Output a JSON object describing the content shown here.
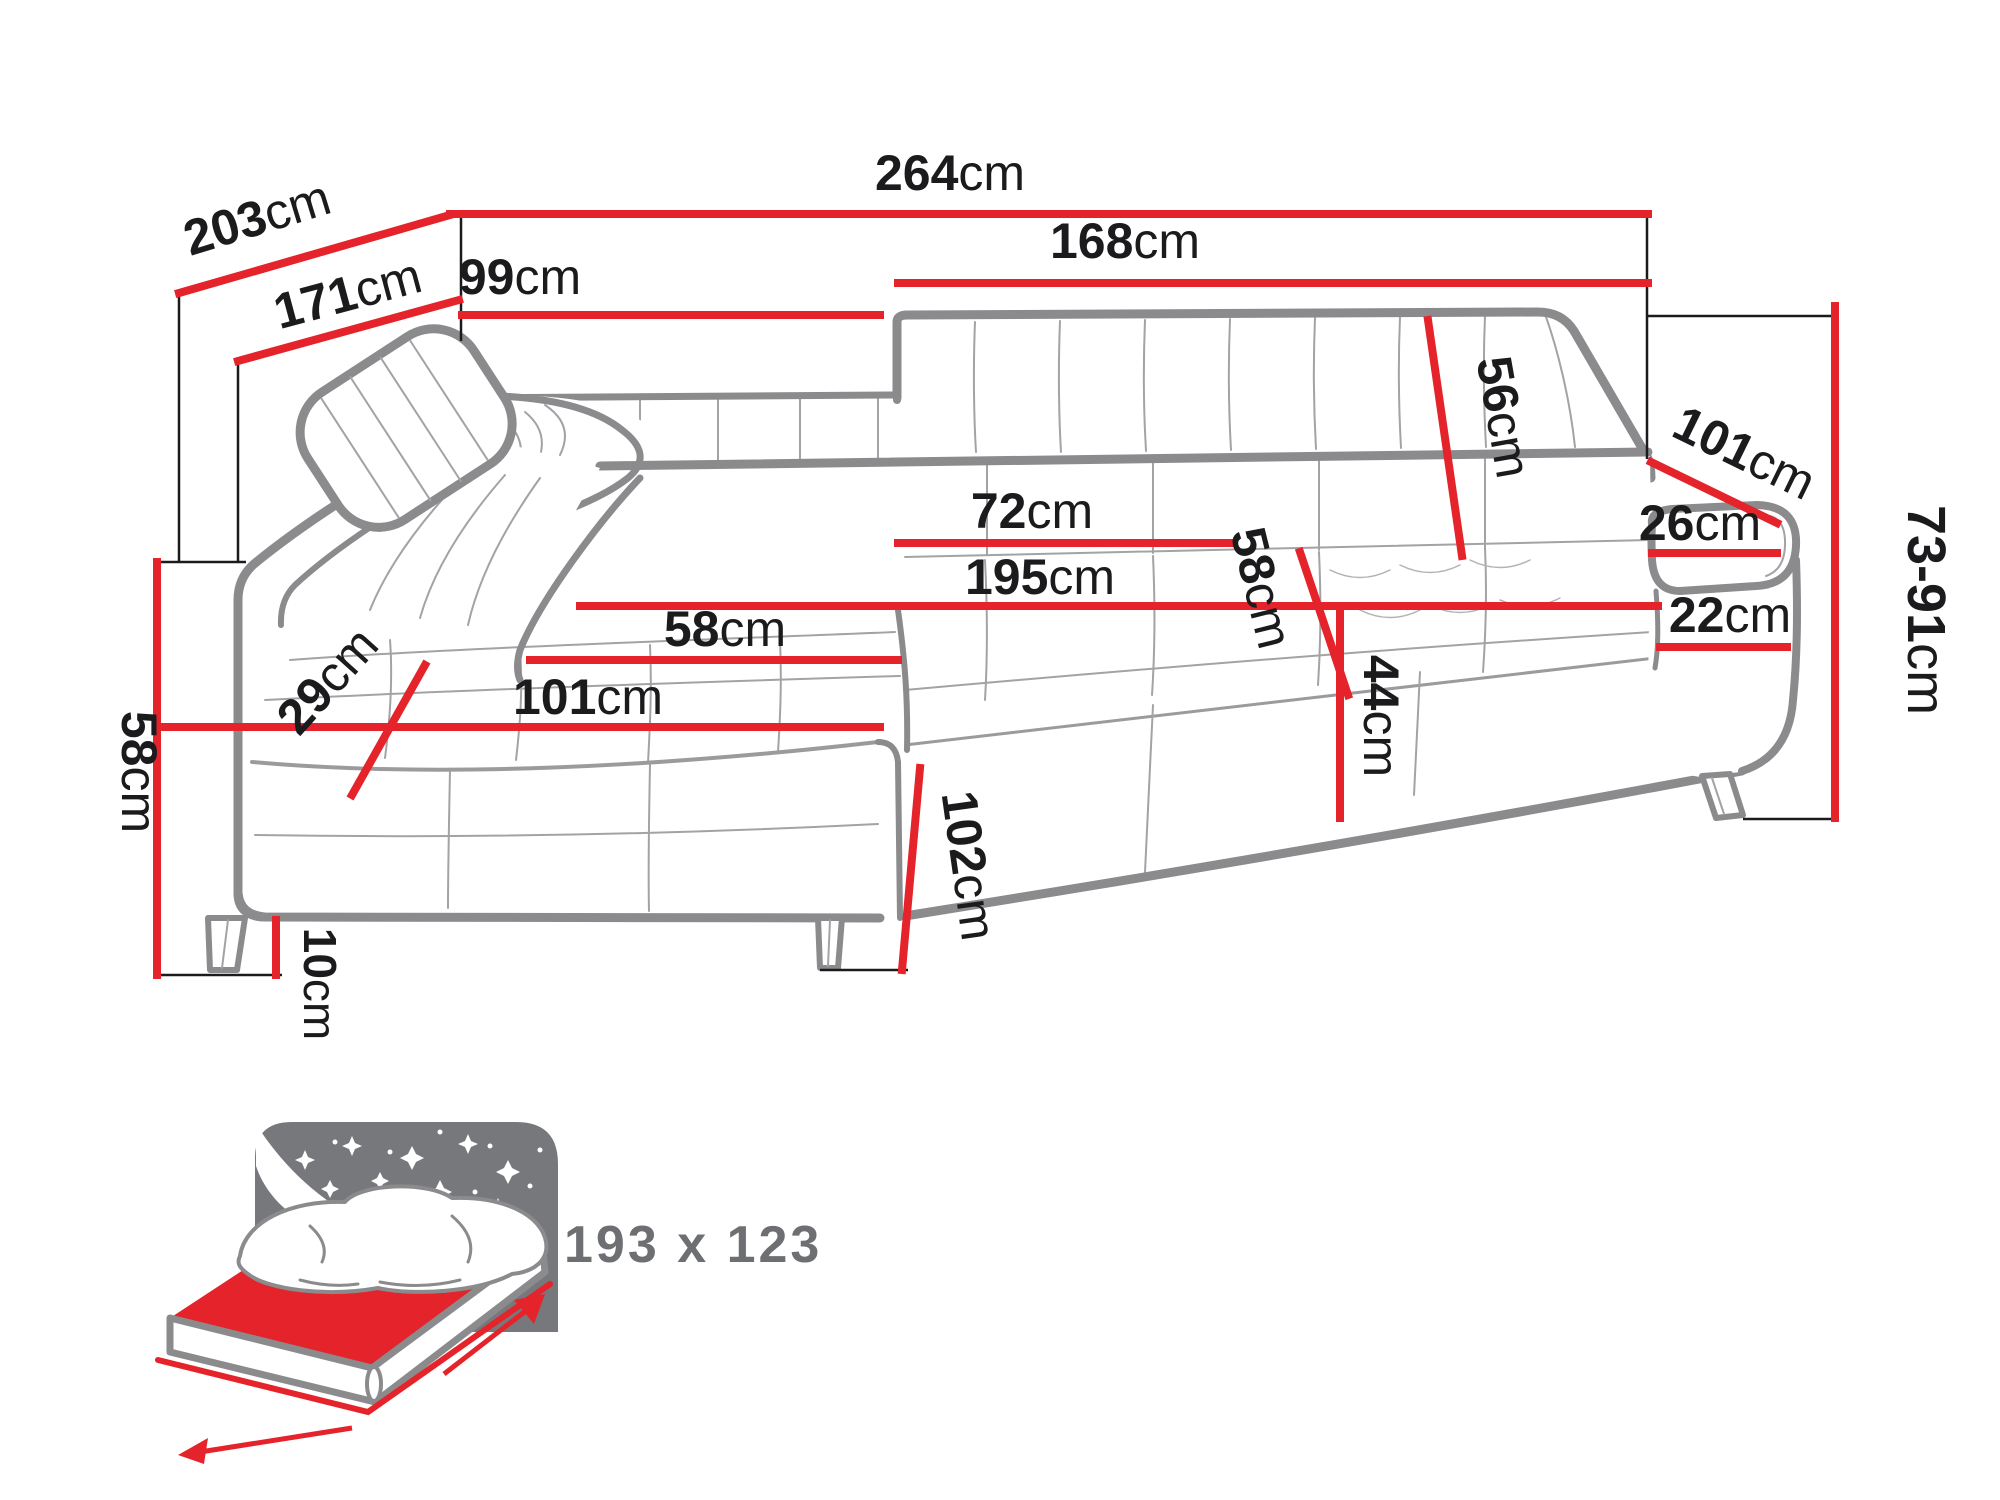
{
  "diagram": {
    "title": "corner-sofa-dimension-drawing",
    "unit": "cm",
    "colors": {
      "dimension_line_red": "#e5232b",
      "outline_gray": "#8b8b8d",
      "seam_gray": "#a3a3a5",
      "label_black": "#1b1b1d",
      "bed_icon_gray": "#77787c",
      "bed_text_gray": "#6e6f73",
      "background": "#ffffff"
    },
    "dimensions": {
      "width_total": {
        "value": "264",
        "unit": "cm"
      },
      "depth_total": {
        "value": "203",
        "unit": "cm"
      },
      "depth_inner": {
        "value": "171",
        "unit": "cm"
      },
      "chaise_width": {
        "value": "99",
        "unit": "cm"
      },
      "seat_section_width": {
        "value": "168",
        "unit": "cm"
      },
      "backrest_height": {
        "value": "56",
        "unit": "cm"
      },
      "side_depth": {
        "value": "101",
        "unit": "cm"
      },
      "armrest_width": {
        "value": "26",
        "unit": "cm"
      },
      "height_range": {
        "value": "73-91",
        "unit": "cm"
      },
      "armrest_height": {
        "value": "22",
        "unit": "cm"
      },
      "seat_depth_back": {
        "value": "72",
        "unit": "cm"
      },
      "seat_length": {
        "value": "195",
        "unit": "cm"
      },
      "seat_depth": {
        "value": "58",
        "unit": "cm"
      },
      "seat_height": {
        "value": "44",
        "unit": "cm"
      },
      "chaise_seat_width": {
        "value": "58",
        "unit": "cm"
      },
      "chaise_length": {
        "value": "101",
        "unit": "cm"
      },
      "cushion_thickness": {
        "value": "29",
        "unit": "cm"
      },
      "side_height": {
        "value": "58",
        "unit": "cm"
      },
      "leg_height": {
        "value": "10",
        "unit": "cm"
      },
      "chaise_depth": {
        "value": "102",
        "unit": "cm"
      }
    },
    "sleeping_area": {
      "label": "193 x 123"
    }
  }
}
